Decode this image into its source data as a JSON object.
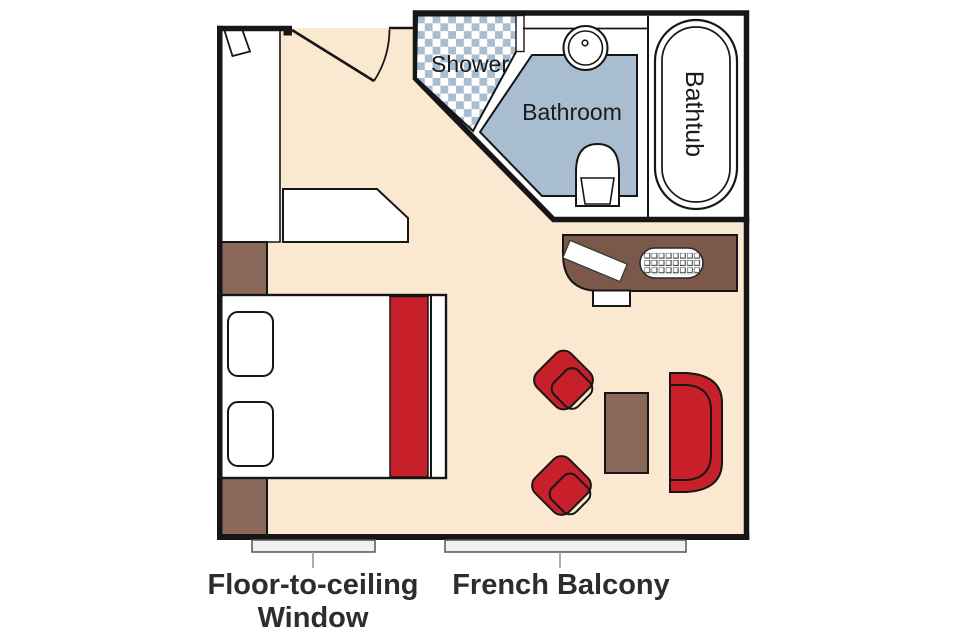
{
  "plan": {
    "rooms": {
      "shower": "Shower",
      "bathroom": "Bathroom",
      "bathtub": "Bathtub"
    },
    "annotations": {
      "window_line1": "Floor-to-ceiling",
      "window_line2": "Window",
      "balcony": "French Balcony"
    },
    "colors": {
      "floor": "#fbe8d0",
      "wall": "#161616",
      "tile_blue": "#a9bdd1",
      "bathroom_floor": "#a9bdd1",
      "accent_red": "#c7202b",
      "desk_brown": "#7b584a",
      "furniture_brown": "#8a695c",
      "fixture_white": "#ffffff",
      "window_bar": "#f1f1f1",
      "label_text": "#2d2d2d"
    }
  }
}
